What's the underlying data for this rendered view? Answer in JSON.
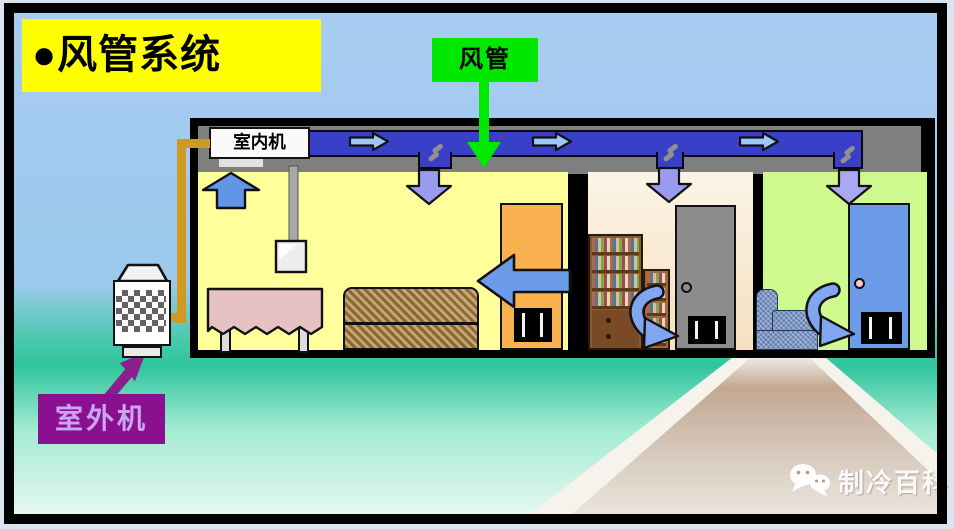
{
  "title": {
    "text": "●风管系统"
  },
  "callout": {
    "duct_label": "风管"
  },
  "building": {
    "indoor_unit_label": "室内机"
  },
  "outdoor_unit": {
    "label": "室外机"
  },
  "watermark": {
    "text": "制冷百科"
  },
  "colors": {
    "sky_top": "#A9CCF1",
    "teal_mid": "#2EC59D",
    "mint_bottom": "#E6F8F2",
    "title_bg": "#FFFF00",
    "callout_bg": "#00E800",
    "duct_blue": "#3A3FC8",
    "duct_arrow_blue": "#9CC8F8",
    "airflow_blue": "#6C9BEA",
    "down_arrow_purple_blue": "#9B9BEE",
    "pipe_gold": "#D09A20",
    "outdoor_label_bg": "#8B1090",
    "outdoor_label_text": "#C9A6F2",
    "ceiling_gray": "#7F7F7F",
    "room1_bg": "#FFFF9C",
    "room2_bg": "#F8ECD6",
    "room3_bg": "#CDF98E",
    "door1_orange": "#F9B04E",
    "door2_gray": "#8C8C8C",
    "door3_blue": "#6C9BEA"
  }
}
